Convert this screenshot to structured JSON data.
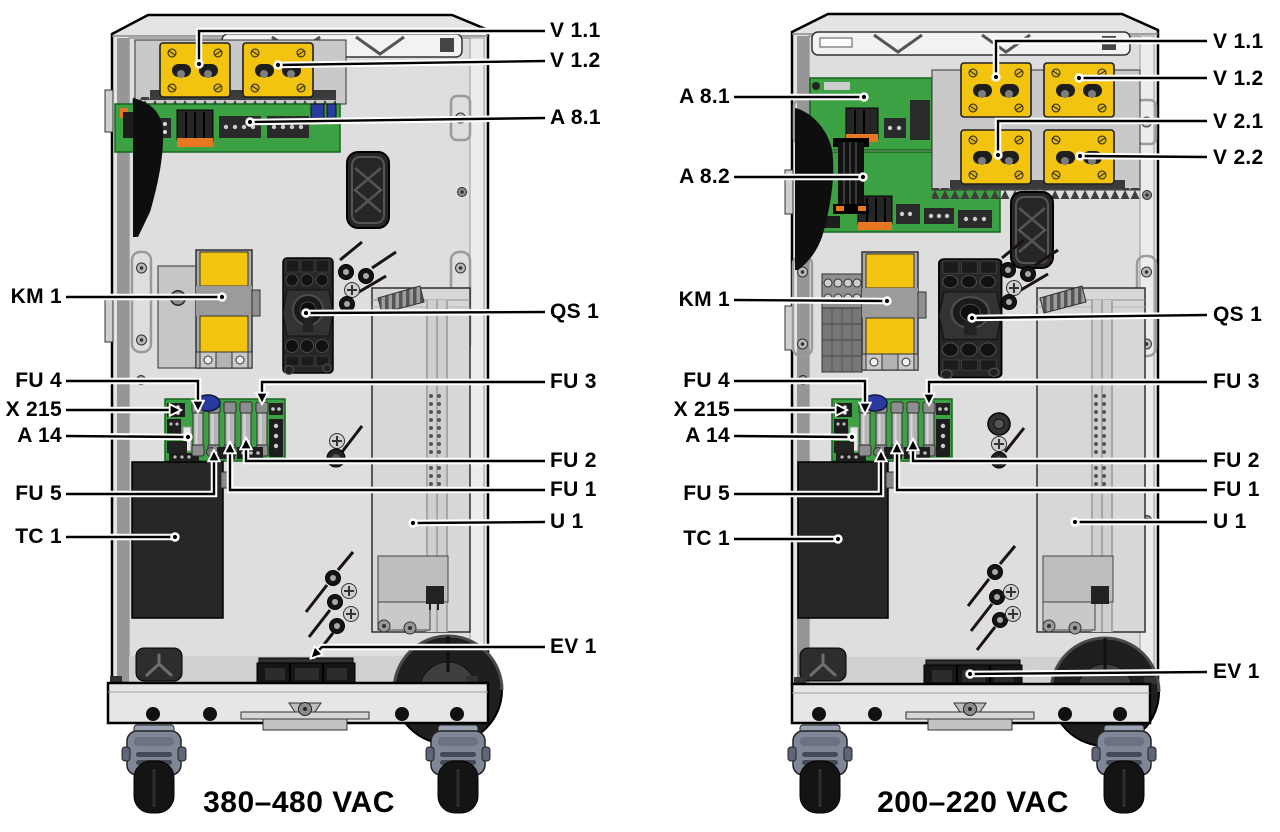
{
  "figure": {
    "type": "technical-diagram",
    "panels": [
      {
        "id": "left",
        "caption": "380–480 VAC",
        "labels": {
          "v11": "V 1.1",
          "v12": "V 1.2",
          "a81": "A 8.1",
          "km1": "KM 1",
          "qs1": "QS 1",
          "fu4": "FU 4",
          "x215": "X 215",
          "a14": "A 14",
          "fu3": "FU 3",
          "fu2": "FU 2",
          "fu1": "FU 1",
          "fu5": "FU 5",
          "u1": "U 1",
          "tc1": "TC 1",
          "ev1": "EV 1"
        }
      },
      {
        "id": "right",
        "caption": "200–220 VAC",
        "labels": {
          "v11": "V 1.1",
          "v12": "V 1.2",
          "v21": "V 2.1",
          "v22": "V 2.2",
          "a81": "A 8.1",
          "a82": "A 8.2",
          "km1": "KM 1",
          "qs1": "QS 1",
          "fu4": "FU 4",
          "x215": "X 215",
          "a14": "A 14",
          "fu3": "FU 3",
          "fu2": "FU 2",
          "fu1": "FU 1",
          "fu5": "FU 5",
          "u1": "U 1",
          "tc1": "TC 1",
          "ev1": "EV 1"
        }
      }
    ],
    "colors": {
      "module_yellow": "#f2c410",
      "pcb_green": "#3ba143",
      "cabinet_gray": "#e4e4e4",
      "accent_orange": "#e87722",
      "connector_blue": "#2b3a9e",
      "caster_gray": "#7e8698",
      "line_black": "#000000"
    }
  }
}
